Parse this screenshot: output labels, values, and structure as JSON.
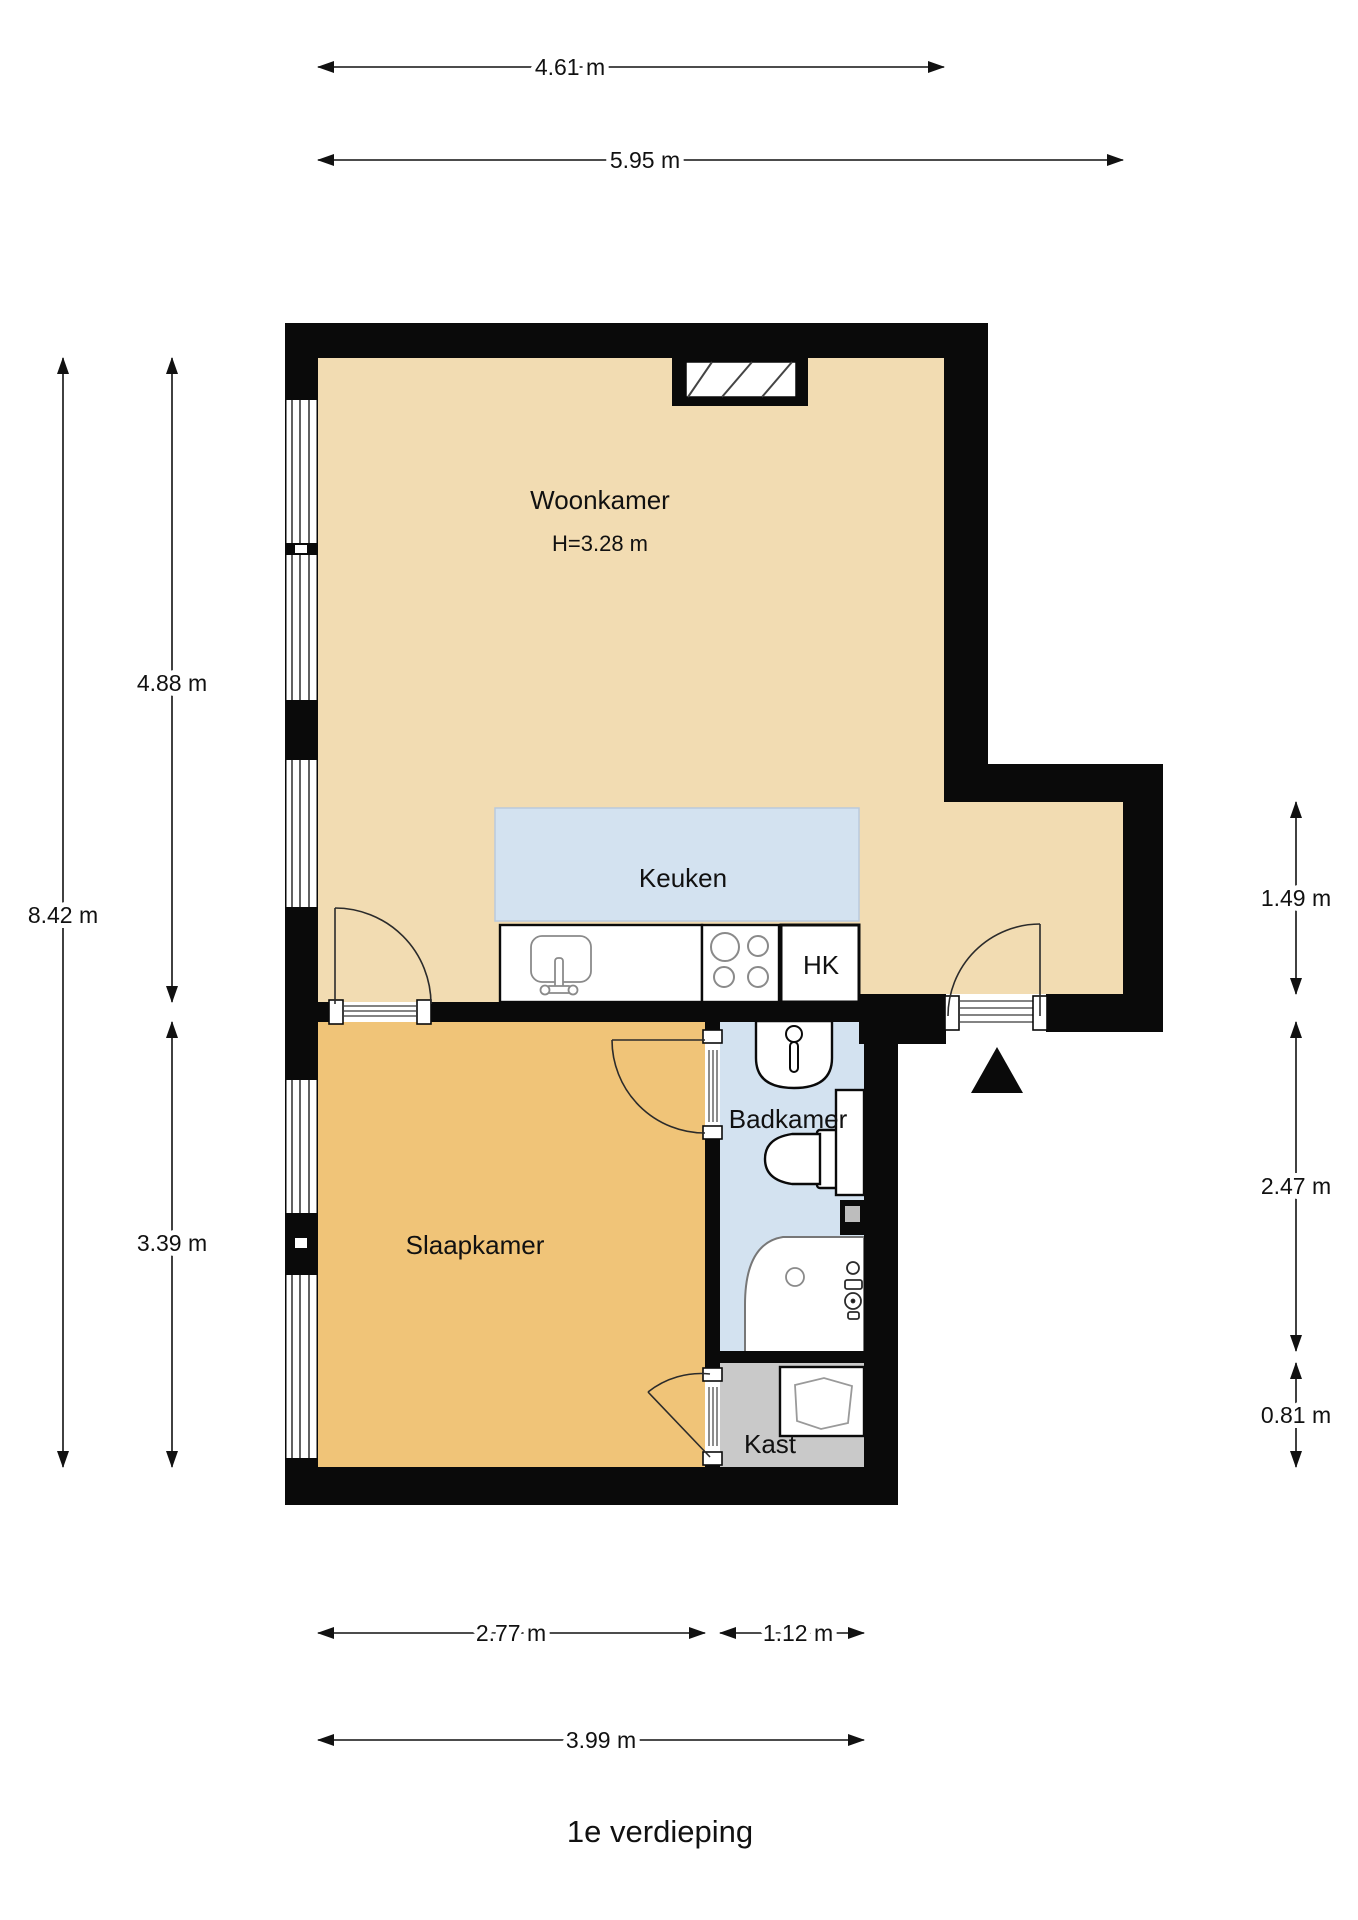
{
  "title": "1e verdieping",
  "colors": {
    "wall": "#0a0a0a",
    "woonkamer_floor": "#F2DCB2",
    "slaapkamer_floor": "#F0C478",
    "wet_floor": "#D3E2F0",
    "kast_floor": "#C9C9C9"
  },
  "rooms": {
    "woonkamer": {
      "label": "Woonkamer",
      "height_note": "H=3.28 m"
    },
    "keuken": {
      "label": "Keuken"
    },
    "badkamer": {
      "label": "Badkamer"
    },
    "slaapkamer": {
      "label": "Slaapkamer"
    },
    "kast": {
      "label": "Kast"
    },
    "hk": {
      "label": "HK"
    }
  },
  "dimensions": {
    "top": [
      {
        "label": "4.61 m"
      },
      {
        "label": "5.95 m"
      }
    ],
    "left": [
      {
        "label": "8.42 m"
      },
      {
        "label": "4.88 m"
      },
      {
        "label": "3.39 m"
      }
    ],
    "right": [
      {
        "label": "1.49 m"
      },
      {
        "label": "2.47 m"
      },
      {
        "label": "0.81 m"
      }
    ],
    "bottom": [
      {
        "label": "2.77 m"
      },
      {
        "label": "1.12 m"
      },
      {
        "label": "3.99 m"
      }
    ]
  },
  "fixtures": [
    "kitchen-sink",
    "stove",
    "hk-closet",
    "washbasin",
    "toilet",
    "shower",
    "wardrobe",
    "shaft"
  ],
  "entrance_marker": "entrance-triangle"
}
